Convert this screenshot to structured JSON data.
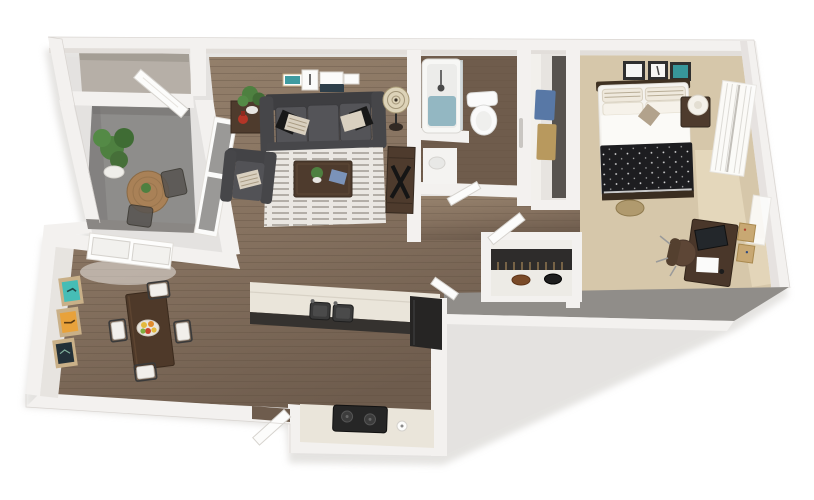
{
  "scene": {
    "type": "3d-floor-plan",
    "description": "dollhouse top-down render of a one-bedroom apartment, no text labels",
    "background": "#ffffff"
  },
  "palette": {
    "background": "#ffffff",
    "wall": "#f3f1ef",
    "wall_inner": "#ddd9d5",
    "wall_shadow": "#908d89",
    "wood_floor": "#8a7666",
    "bathroom_floor": "#6f5c4c",
    "balcony_concrete": "#8e8d8b",
    "storage_floor": "#b6afa7",
    "carpet": "#d6c7aa",
    "carpet_light": "#efe3c6",
    "closet_floor": "#edebe6",
    "rug": "#eae7e2",
    "rug_stripe": "#b3aea7",
    "sofa": "#4c4c4f",
    "cushion": "#545458",
    "duvet": "#1d1d20",
    "linen": "#f5f3ef",
    "pillow_cream": "#d9d0c0",
    "dark_wood": "#4e3b2d",
    "red_vase": "#b43527",
    "plant_green": "#4e8040",
    "lamp_shade": "#ddd3b8",
    "tub_water": "#93b7c2",
    "porcelain": "#fafafa",
    "teal_art": "#46bdb6",
    "orange_art": "#e8a23b",
    "navy_art": "#223038",
    "denim_clothes": "#5878a6",
    "tan_clothes": "#b8995e",
    "counter": "#eae5da",
    "cabinet_dark": "#262524",
    "cork": "#c8a873"
  },
  "rooms": [
    {
      "id": "storage-closet",
      "furniture": []
    },
    {
      "id": "balcony",
      "furniture": [
        "potted-plant",
        "bistro-table",
        "patio-chair",
        "patio-chair",
        "open-door"
      ]
    },
    {
      "id": "living-room",
      "furniture": [
        "gallery-wall-art",
        "side-table",
        "red-vase",
        "potted-plant",
        "sofa",
        "throw-pillows",
        "floor-lamp",
        "media-console",
        "accent-chair",
        "striped-area-rug",
        "coffee-table",
        "sliding-glass-door"
      ]
    },
    {
      "id": "dining-area",
      "furniture": [
        "wall-art-teal",
        "wall-art-orange",
        "wall-art-navy",
        "window",
        "dining-table",
        "fruit-bowl",
        "dining-chair",
        "dining-chair",
        "dining-chair",
        "dining-chair",
        "entry-door"
      ]
    },
    {
      "id": "kitchen",
      "furniture": [
        "peninsula-counter",
        "double-basin-sink",
        "refrigerator",
        "range-counter",
        "cooktop"
      ]
    },
    {
      "id": "bathroom",
      "furniture": [
        "bathtub",
        "shower-fixture",
        "toilet",
        "vanity",
        "towel-bar",
        "door"
      ]
    },
    {
      "id": "walk-in-closet",
      "furniture": [
        "hanging-clothes-blue",
        "hanging-clothes-tan"
      ]
    },
    {
      "id": "hallway",
      "furniture": [
        "door",
        "door"
      ]
    },
    {
      "id": "bedroom",
      "furniture": [
        "picture-frames",
        "bed",
        "striped-pillows",
        "black-dotted-duvet",
        "nightstand",
        "table-lamp",
        "window-curtains",
        "duffel-bag",
        "desk",
        "monitor",
        "office-chair",
        "pin-boards"
      ]
    },
    {
      "id": "bedroom-closet",
      "furniture": [
        "hanging-clothes",
        "shoes"
      ]
    }
  ]
}
